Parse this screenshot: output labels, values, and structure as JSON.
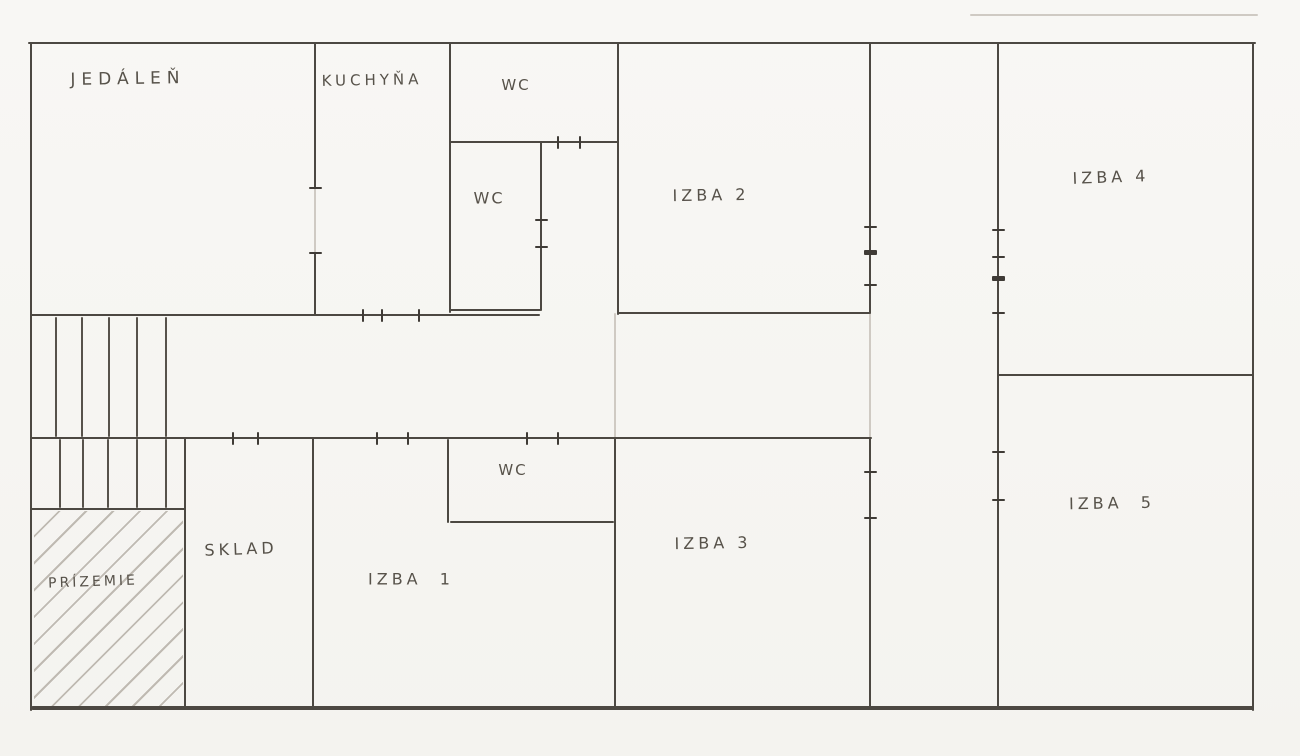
{
  "colors": {
    "paper": "#f6f5f2",
    "pencil": "#4c4842",
    "pencil_light": "#cfcac3",
    "label_ink": "#57524a"
  },
  "floorplan": {
    "rooms": [
      {
        "id": "jedalen",
        "label": "JEDÁLEŇ",
        "cx": 128,
        "cy": 79,
        "fs": 17,
        "ls": 6,
        "rot": -1
      },
      {
        "id": "kuchyna",
        "label": "KUCHYŇA",
        "cx": 372,
        "cy": 80,
        "fs": 15,
        "ls": 4,
        "rot": -1
      },
      {
        "id": "wc-top",
        "label": "WC",
        "cx": 516,
        "cy": 85,
        "fs": 15,
        "ls": 2,
        "rot": 0
      },
      {
        "id": "wc-mid",
        "label": "WC",
        "cx": 489,
        "cy": 198,
        "fs": 16,
        "ls": 2,
        "rot": 0
      },
      {
        "id": "izba-2",
        "label": "IZBA 2",
        "cx": 711,
        "cy": 195,
        "fs": 16,
        "ls": 4,
        "rot": -1
      },
      {
        "id": "izba-4",
        "label": "IZBA 4",
        "cx": 1111,
        "cy": 177,
        "fs": 16,
        "ls": 4,
        "rot": -2
      },
      {
        "id": "wc-bottom",
        "label": "WC",
        "cx": 513,
        "cy": 470,
        "fs": 15,
        "ls": 2,
        "rot": 0
      },
      {
        "id": "sklad",
        "label": "SKLAD",
        "cx": 241,
        "cy": 549,
        "fs": 16,
        "ls": 4,
        "rot": -2
      },
      {
        "id": "izba-1",
        "label": "IZBA  1",
        "cx": 411,
        "cy": 579,
        "fs": 16,
        "ls": 4,
        "rot": 0
      },
      {
        "id": "izba-3",
        "label": "IZBA 3",
        "cx": 713,
        "cy": 543,
        "fs": 16,
        "ls": 4,
        "rot": -1
      },
      {
        "id": "izba-5",
        "label": "IZBA  5",
        "cx": 1112,
        "cy": 503,
        "fs": 16,
        "ls": 4,
        "rot": -1
      },
      {
        "id": "prizemie",
        "label": "PRÍZEMIE",
        "cx": 93,
        "cy": 582,
        "fs": 14,
        "ls": 3,
        "rot": -2
      }
    ],
    "walls": [
      {
        "x1": 28,
        "y1": 43,
        "x2": 1256,
        "y2": 43,
        "t": 2.5
      },
      {
        "x1": 31,
        "y1": 43,
        "x2": 31,
        "y2": 711,
        "t": 2.5
      },
      {
        "x1": 1253,
        "y1": 43,
        "x2": 1253,
        "y2": 711,
        "t": 2.5
      },
      {
        "x1": 31,
        "y1": 708,
        "x2": 1254,
        "y2": 708,
        "t": 3.5
      },
      {
        "x1": 315,
        "y1": 43,
        "x2": 315,
        "y2": 189,
        "t": 2.5
      },
      {
        "x1": 315,
        "y1": 252,
        "x2": 315,
        "y2": 316,
        "t": 2.5
      },
      {
        "x1": 450,
        "y1": 43,
        "x2": 450,
        "y2": 313,
        "t": 2.5
      },
      {
        "x1": 541,
        "y1": 142,
        "x2": 541,
        "y2": 311,
        "t": 2.5
      },
      {
        "x1": 618,
        "y1": 43,
        "x2": 618,
        "y2": 315,
        "t": 2.5
      },
      {
        "x1": 870,
        "y1": 43,
        "x2": 870,
        "y2": 314,
        "t": 2.5
      },
      {
        "x1": 870,
        "y1": 437,
        "x2": 870,
        "y2": 709,
        "t": 2.5
      },
      {
        "x1": 998,
        "y1": 43,
        "x2": 998,
        "y2": 709,
        "t": 2.5
      },
      {
        "x1": 615,
        "y1": 437,
        "x2": 615,
        "y2": 709,
        "t": 2.5
      },
      {
        "x1": 313,
        "y1": 437,
        "x2": 313,
        "y2": 709,
        "t": 2.5
      },
      {
        "x1": 185,
        "y1": 437,
        "x2": 185,
        "y2": 709,
        "t": 2.5
      },
      {
        "x1": 448,
        "y1": 439,
        "x2": 448,
        "y2": 523,
        "t": 2.5
      },
      {
        "x1": 31,
        "y1": 315,
        "x2": 540,
        "y2": 315,
        "t": 2.5
      },
      {
        "x1": 618,
        "y1": 313,
        "x2": 870,
        "y2": 313,
        "t": 2.5
      },
      {
        "x1": 450,
        "y1": 142,
        "x2": 618,
        "y2": 142,
        "t": 2.5
      },
      {
        "x1": 450,
        "y1": 310,
        "x2": 541,
        "y2": 310,
        "t": 2.5
      },
      {
        "x1": 31,
        "y1": 438,
        "x2": 872,
        "y2": 438,
        "t": 2.5
      },
      {
        "x1": 450,
        "y1": 522,
        "x2": 614,
        "y2": 522,
        "t": 2.5
      },
      {
        "x1": 31,
        "y1": 509,
        "x2": 185,
        "y2": 509,
        "t": 2.5
      },
      {
        "x1": 998,
        "y1": 375,
        "x2": 1253,
        "y2": 375,
        "t": 2.5
      }
    ],
    "faint_lines": [
      {
        "x1": 315,
        "y1": 187,
        "x2": 315,
        "y2": 254
      },
      {
        "x1": 870,
        "y1": 312,
        "x2": 870,
        "y2": 438
      },
      {
        "x1": 615,
        "y1": 313,
        "x2": 615,
        "y2": 438
      },
      {
        "x1": 970,
        "y1": 15,
        "x2": 1258,
        "y2": 15
      }
    ],
    "stair_treads": [
      {
        "x": 56,
        "y1": 317,
        "y2": 437
      },
      {
        "x": 82,
        "y1": 317,
        "y2": 437
      },
      {
        "x": 109,
        "y1": 317,
        "y2": 437
      },
      {
        "x": 137,
        "y1": 317,
        "y2": 437
      },
      {
        "x": 166,
        "y1": 317,
        "y2": 437
      },
      {
        "x": 60,
        "y1": 439,
        "y2": 508
      },
      {
        "x": 83,
        "y1": 439,
        "y2": 508
      },
      {
        "x": 108,
        "y1": 439,
        "y2": 508
      },
      {
        "x": 137,
        "y1": 439,
        "y2": 508
      },
      {
        "x": 166,
        "y1": 439,
        "y2": 508
      }
    ],
    "door_ticks": [
      {
        "x": 315,
        "y": 188,
        "o": "v"
      },
      {
        "x": 315,
        "y": 253,
        "o": "v"
      },
      {
        "x": 541,
        "y": 220,
        "o": "v"
      },
      {
        "x": 541,
        "y": 247,
        "o": "v"
      },
      {
        "x": 870,
        "y": 227,
        "o": "v"
      },
      {
        "x": 870,
        "y": 252,
        "o": "v",
        "bold": true
      },
      {
        "x": 870,
        "y": 285,
        "o": "v"
      },
      {
        "x": 998,
        "y": 230,
        "o": "v"
      },
      {
        "x": 998,
        "y": 257,
        "o": "v"
      },
      {
        "x": 998,
        "y": 278,
        "o": "v",
        "bold": true
      },
      {
        "x": 998,
        "y": 313,
        "o": "v"
      },
      {
        "x": 870,
        "y": 472,
        "o": "v"
      },
      {
        "x": 870,
        "y": 518,
        "o": "v"
      },
      {
        "x": 998,
        "y": 452,
        "o": "v"
      },
      {
        "x": 998,
        "y": 500,
        "o": "v"
      },
      {
        "x": 558,
        "y": 142,
        "o": "h"
      },
      {
        "x": 580,
        "y": 142,
        "o": "h"
      },
      {
        "x": 363,
        "y": 315,
        "o": "h"
      },
      {
        "x": 382,
        "y": 315,
        "o": "h"
      },
      {
        "x": 419,
        "y": 315,
        "o": "h"
      },
      {
        "x": 233,
        "y": 438,
        "o": "h"
      },
      {
        "x": 258,
        "y": 438,
        "o": "h"
      },
      {
        "x": 377,
        "y": 438,
        "o": "h"
      },
      {
        "x": 408,
        "y": 438,
        "o": "h"
      },
      {
        "x": 527,
        "y": 438,
        "o": "h"
      },
      {
        "x": 558,
        "y": 438,
        "o": "h"
      }
    ],
    "hatch": {
      "x": 34,
      "y": 511,
      "w": 149,
      "h": 197
    }
  }
}
